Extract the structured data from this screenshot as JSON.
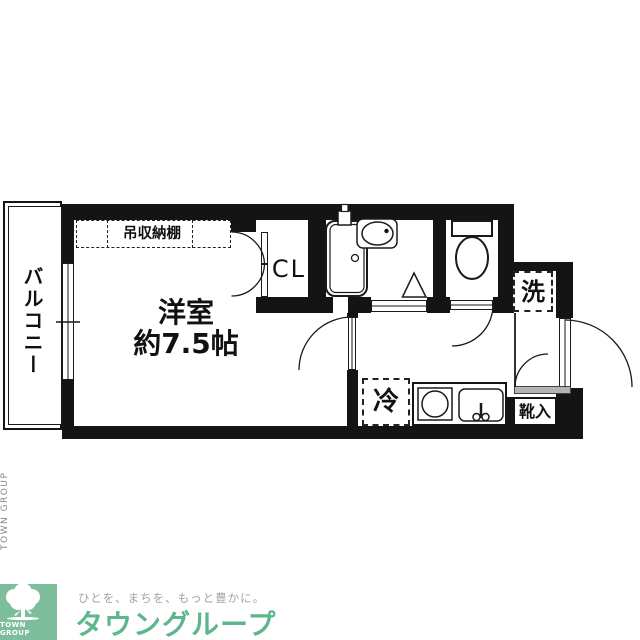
{
  "floorplan": {
    "balcony": "バルコニー",
    "shelf": "吊収納棚",
    "closet": "CL",
    "room_name": "洋室",
    "room_size": "約7.5帖",
    "washer": "洗",
    "fridge": "冷",
    "shoebox": "靴入"
  },
  "branding": {
    "side_text": "TOWN GROUP",
    "logo_text": "TOWN GROUP",
    "tagline": "ひとを、まちを、もっと豊かに。",
    "company": "タウングループ",
    "logo_green": "#7cbd9b",
    "company_green": "#5eb78c",
    "tagline_gray": "#a3a3a3"
  },
  "colors": {
    "wall": "#141414",
    "line": "#1a1a1a",
    "sill": "#b3b3b3"
  }
}
